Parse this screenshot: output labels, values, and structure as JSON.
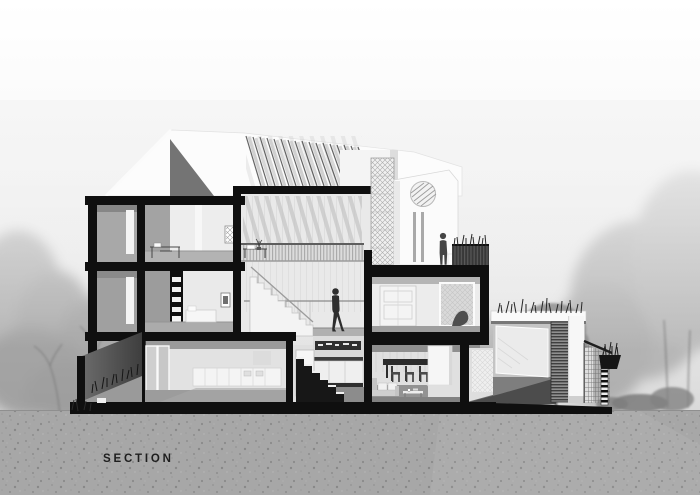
{
  "drawing": {
    "label": "SECTION",
    "type": "architectural-section-rendering"
  },
  "palette": {
    "ink": "#0f0f0f",
    "sky_top": "#ffffff",
    "sky_bottom": "#cbcbcb",
    "ground": "#a7a7a7",
    "wall_gray": "#9e9e9e",
    "interior_light": "#ededed",
    "figure_silhouette": "#2e2e2e"
  },
  "scene": {
    "figures": [
      "walking-person",
      "standing-person"
    ],
    "elements": [
      "pitched-roof",
      "pergola-louvers",
      "stair-tower",
      "trellis-screen",
      "mezzanine",
      "split-level-stairs",
      "kitchen",
      "dining-room",
      "wardrobe-room",
      "roof-terrace",
      "garage-gate",
      "boundary-fence",
      "retaining-wall",
      "trees",
      "ground"
    ]
  }
}
